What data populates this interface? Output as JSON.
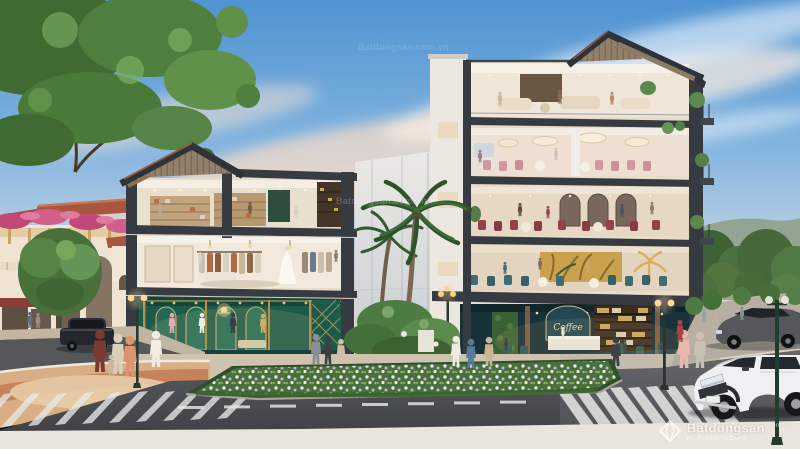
{
  "watermark": {
    "brand": "Batdongsan",
    "domain": ".com.vn",
    "byline": "by PropertyGuru",
    "tile": "Batdongsan.com.vn",
    "logo": "batdongsan-diamond-icon",
    "color": "#ffffff"
  },
  "signs": {
    "cafe_script": "Coffee"
  },
  "palette": {
    "sky_top": "#4f93d2",
    "sky_horizon": "#f6e3d0",
    "cloud_pink": "#f7dcc8",
    "frame_charcoal": "#363b41",
    "roof_wood": "#8d7a64",
    "boutique_emerald": "#1c5a49",
    "boutique_gold": "#c9a24a",
    "cafe_teal": "#173238",
    "terracotta_roof": "#a9563e",
    "bougainvillea_pink": "#c2487a",
    "foliage_green": "#4f7f3e",
    "asphalt": "#4b4d50",
    "pavement": "#eae5dc",
    "plaza_tan": "#d9ae85"
  }
}
